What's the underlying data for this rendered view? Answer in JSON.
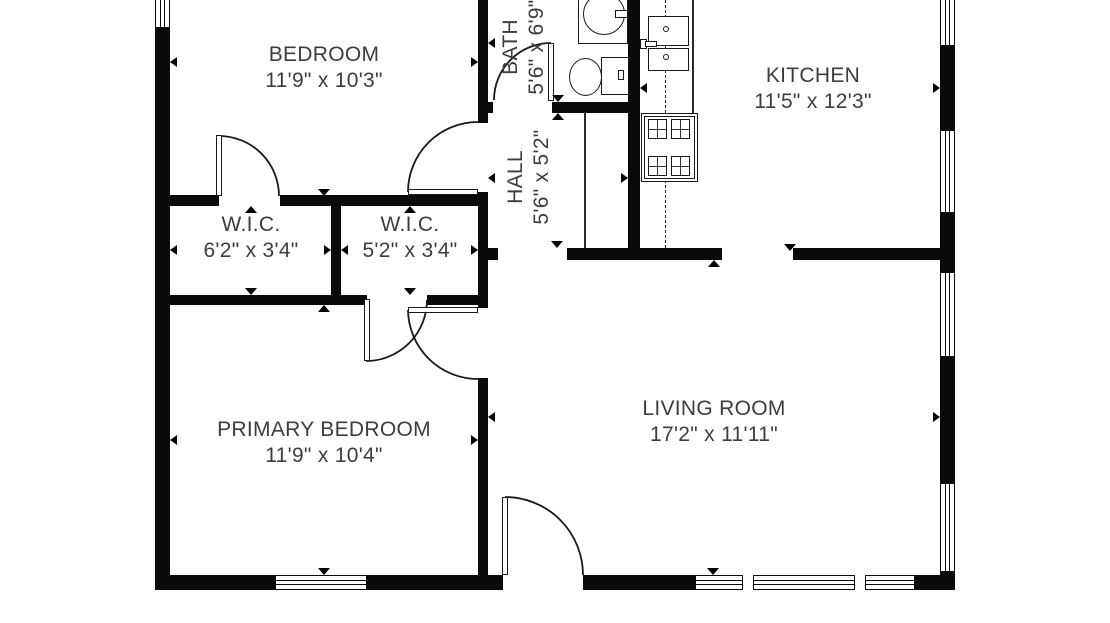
{
  "floorplan": {
    "rooms": {
      "bedroom": {
        "name": "BEDROOM",
        "dims": "11'9\" x 10'3\""
      },
      "bath": {
        "name": "BATH",
        "dims": "5'6\" x 6'9\""
      },
      "kitchen": {
        "name": "KITCHEN",
        "dims": "11'5\" x 12'3\""
      },
      "hall": {
        "name": "HALL",
        "dims": "5'6\" x 5'2\""
      },
      "wic_left": {
        "name": "W.I.C.",
        "dims": "6'2\" x 3'4\""
      },
      "wic_right": {
        "name": "W.I.C.",
        "dims": "5'2\" x 3'4\""
      },
      "primary_bedroom": {
        "name": "PRIMARY BEDROOM",
        "dims": "11'9\" x 10'4\""
      },
      "living_room": {
        "name": "LIVING ROOM",
        "dims": "17'2\" x 11'11\""
      }
    },
    "fixtures": [
      "toilet-icon",
      "bathroom-sink-icon",
      "kitchen-sink-icon",
      "stove-icon"
    ],
    "colors": {
      "wall": "#0a0a0a",
      "label_text": "#3d3d3d",
      "background": "#ffffff"
    }
  }
}
